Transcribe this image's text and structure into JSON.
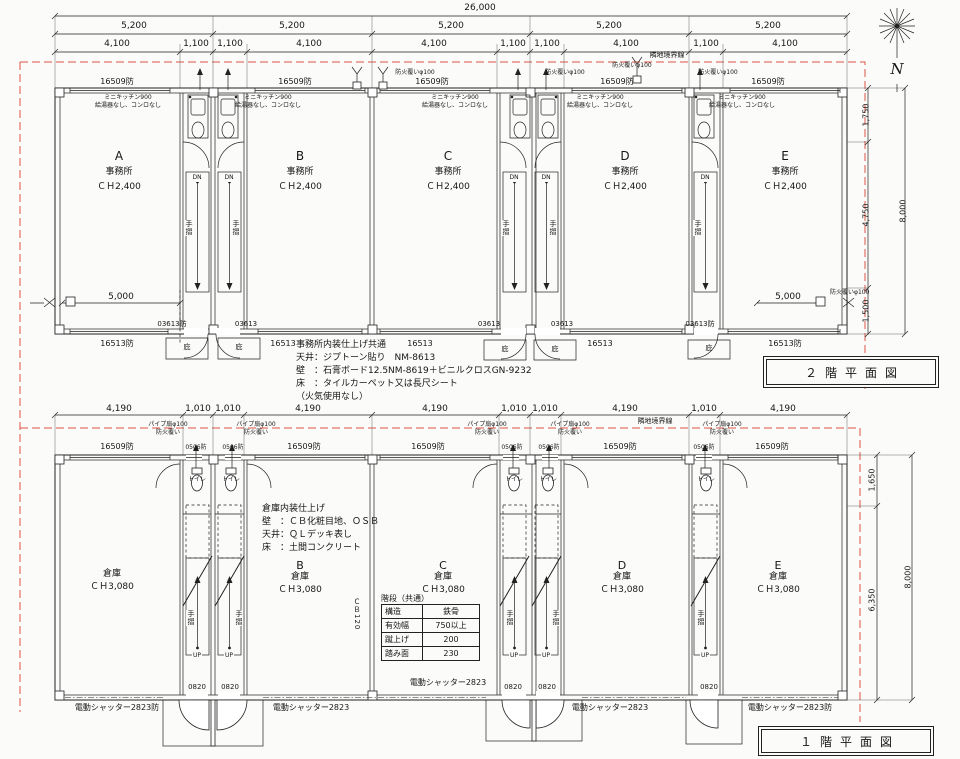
{
  "north": {
    "label": "N"
  },
  "f2": {
    "title": "２階平面図",
    "boundary": "隣地境界線",
    "dims": {
      "total": "26,000",
      "seg": "5,200",
      "a": "4,100",
      "b": "1,100",
      "span": "5,000",
      "r1": "1,750",
      "r2": "4,750",
      "r3": "1,500",
      "rtotal": "8,000"
    },
    "win_top": "16509防",
    "vent": "防火覆いφ100",
    "kitchen1": "ミニキッチン900",
    "kitchen2": "給湯器なし、コンロなし",
    "rooms": {
      "letters": [
        "A",
        "B",
        "C",
        "D",
        "E"
      ],
      "use": "事務所",
      "ch": "ＣＨ2,400"
    },
    "dn": "DN",
    "handrail": "手摺",
    "door_f": "03613防",
    "door": "03613",
    "canopy": "庇",
    "win_b": "16513",
    "win_bf": "16513防",
    "notes": [
      "事務所内装仕上げ共通",
      "天井：ジプトーン貼り　NM-8613",
      "壁　：石膏ボード12.5NM-8619＋ビニルクロスGN-9232",
      "床　：タイルカーペット又は長尺シート",
      "（火気使用なし）"
    ]
  },
  "f1": {
    "title": "１階平面図",
    "boundary": "隣地境界線",
    "dims": {
      "a": "4,190",
      "b": "1,010",
      "r1": "1,650",
      "r2": "6,350",
      "rtotal": "8,000"
    },
    "win_top": "16509防",
    "win_s": "0506防",
    "fan1": "パイプ扇φ100",
    "fan2": "防火覆い",
    "toilet": "トイレ",
    "rooms": {
      "letters": [
        "B",
        "C",
        "D",
        "E"
      ],
      "use": "倉庫",
      "ch": "ＣＨ3,080"
    },
    "up": "UP",
    "handrail": "手摺",
    "door": "0820",
    "wall_label": "ＣＢ120",
    "shutter": "電動シャッター2823",
    "shutter_f": "電動シャッター2823防",
    "notes": [
      "倉庫内装仕上げ",
      "壁　：ＣＢ化粧目地、ＯＳＢ",
      "天井：ＱＬデッキ表し",
      "床　：土間コンクリート"
    ],
    "stair_table": {
      "title": "階段（共通）",
      "rows": [
        [
          "構造",
          "鉄骨"
        ],
        [
          "有効幅",
          "750以上"
        ],
        [
          "蹴上げ",
          "200"
        ],
        [
          "踏み面",
          "230"
        ]
      ]
    }
  }
}
